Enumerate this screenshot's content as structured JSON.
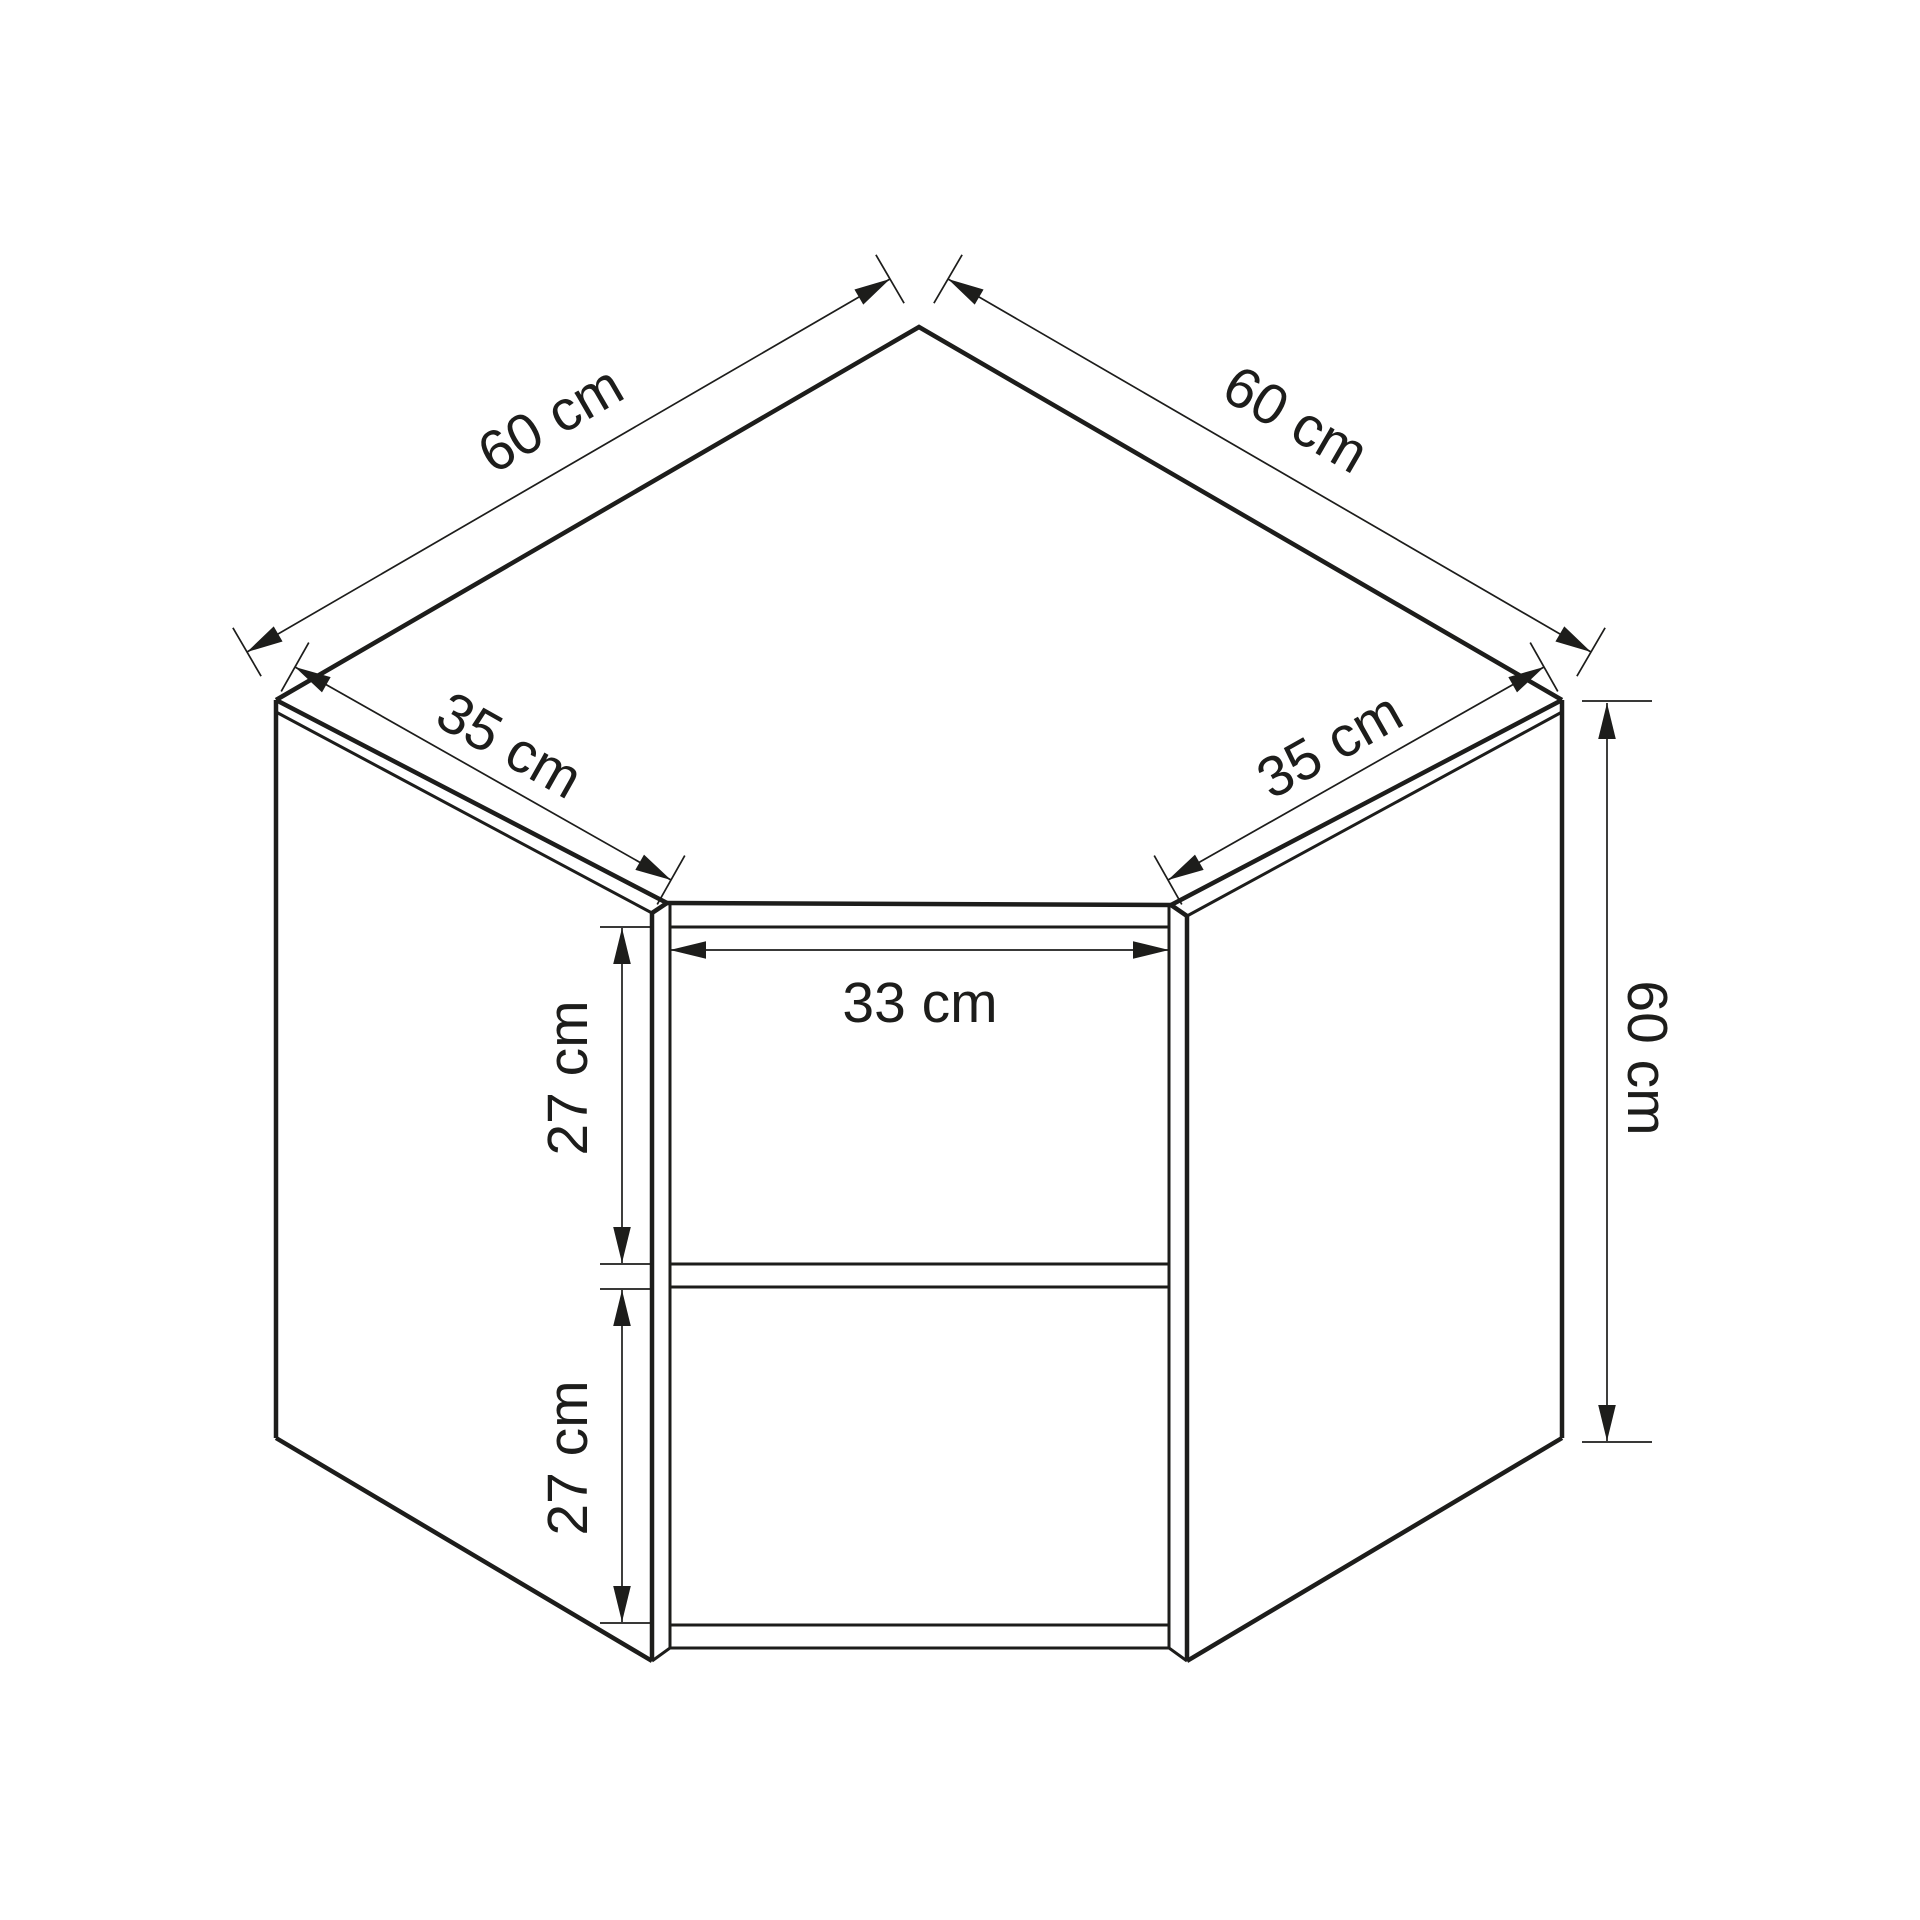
{
  "page": {
    "title": "Corner wall cabinet technical drawing",
    "background_color": "#ffffff",
    "line_color": "#1d1d1b",
    "unit": "cm"
  },
  "cabinet": {
    "type": "corner wall cabinet, open front with one shelf",
    "top_depth_left_cm": 60,
    "top_depth_right_cm": 60,
    "left_door_width_cm": 35,
    "right_door_width_cm": 35,
    "opening_width_cm": 33,
    "upper_compartment_height_cm": 27,
    "lower_compartment_height_cm": 27,
    "side_height_cm": 60
  },
  "dimensions": {
    "top_left_edge": {
      "label": "60 cm"
    },
    "top_right_edge": {
      "label": "60 cm"
    },
    "left_front_edge": {
      "label": "35 cm"
    },
    "right_front_edge": {
      "label": "35 cm"
    },
    "opening_width": {
      "label": "33 cm"
    },
    "upper_compartment": {
      "label": "27 cm"
    },
    "lower_compartment": {
      "label": "27 cm"
    },
    "right_side_height": {
      "label": "60 cm"
    }
  }
}
